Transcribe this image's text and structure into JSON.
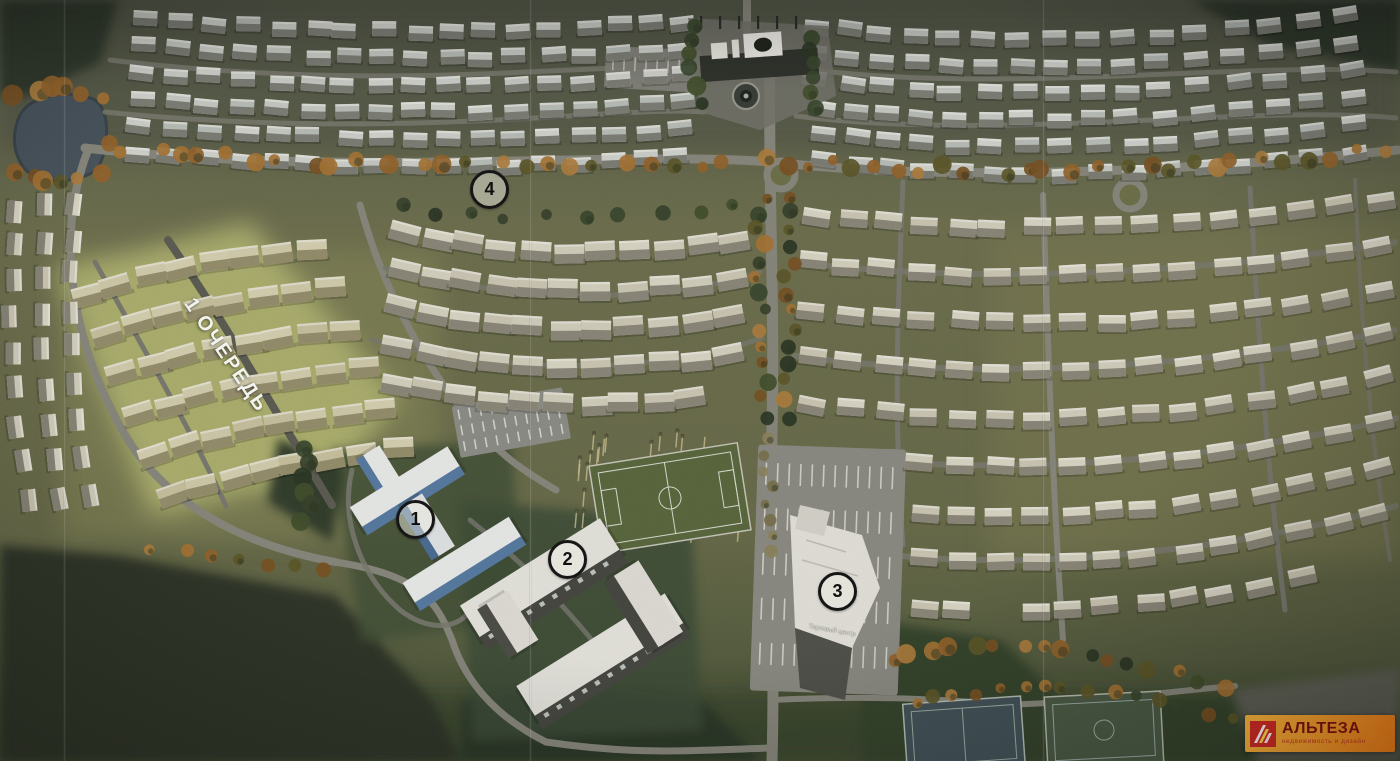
{
  "map": {
    "phase_label": "1 ОЧЕРЕДЬ",
    "building_sign": "Торговый центр",
    "markers": [
      {
        "label": "1",
        "x": 413,
        "y": 517
      },
      {
        "label": "2",
        "x": 565,
        "y": 557
      },
      {
        "label": "3",
        "x": 835,
        "y": 589
      },
      {
        "label": "4",
        "x": 487,
        "y": 187
      }
    ]
  },
  "logo": {
    "brand": "АЛЬТЕЗА",
    "tagline": "недвижимость и дизайн"
  },
  "colors": {
    "logo_gradient_start": "#f7b53c",
    "logo_gradient_end": "#ee7d18",
    "logo_icon_red": "#cf2b26",
    "logo_icon_yellow": "#ffd74d",
    "logo_brand_text": "#7e150f",
    "logo_tagline_text": "#c23a22",
    "phase_highlight": "#b5b873",
    "marker_ring": "#161616"
  }
}
